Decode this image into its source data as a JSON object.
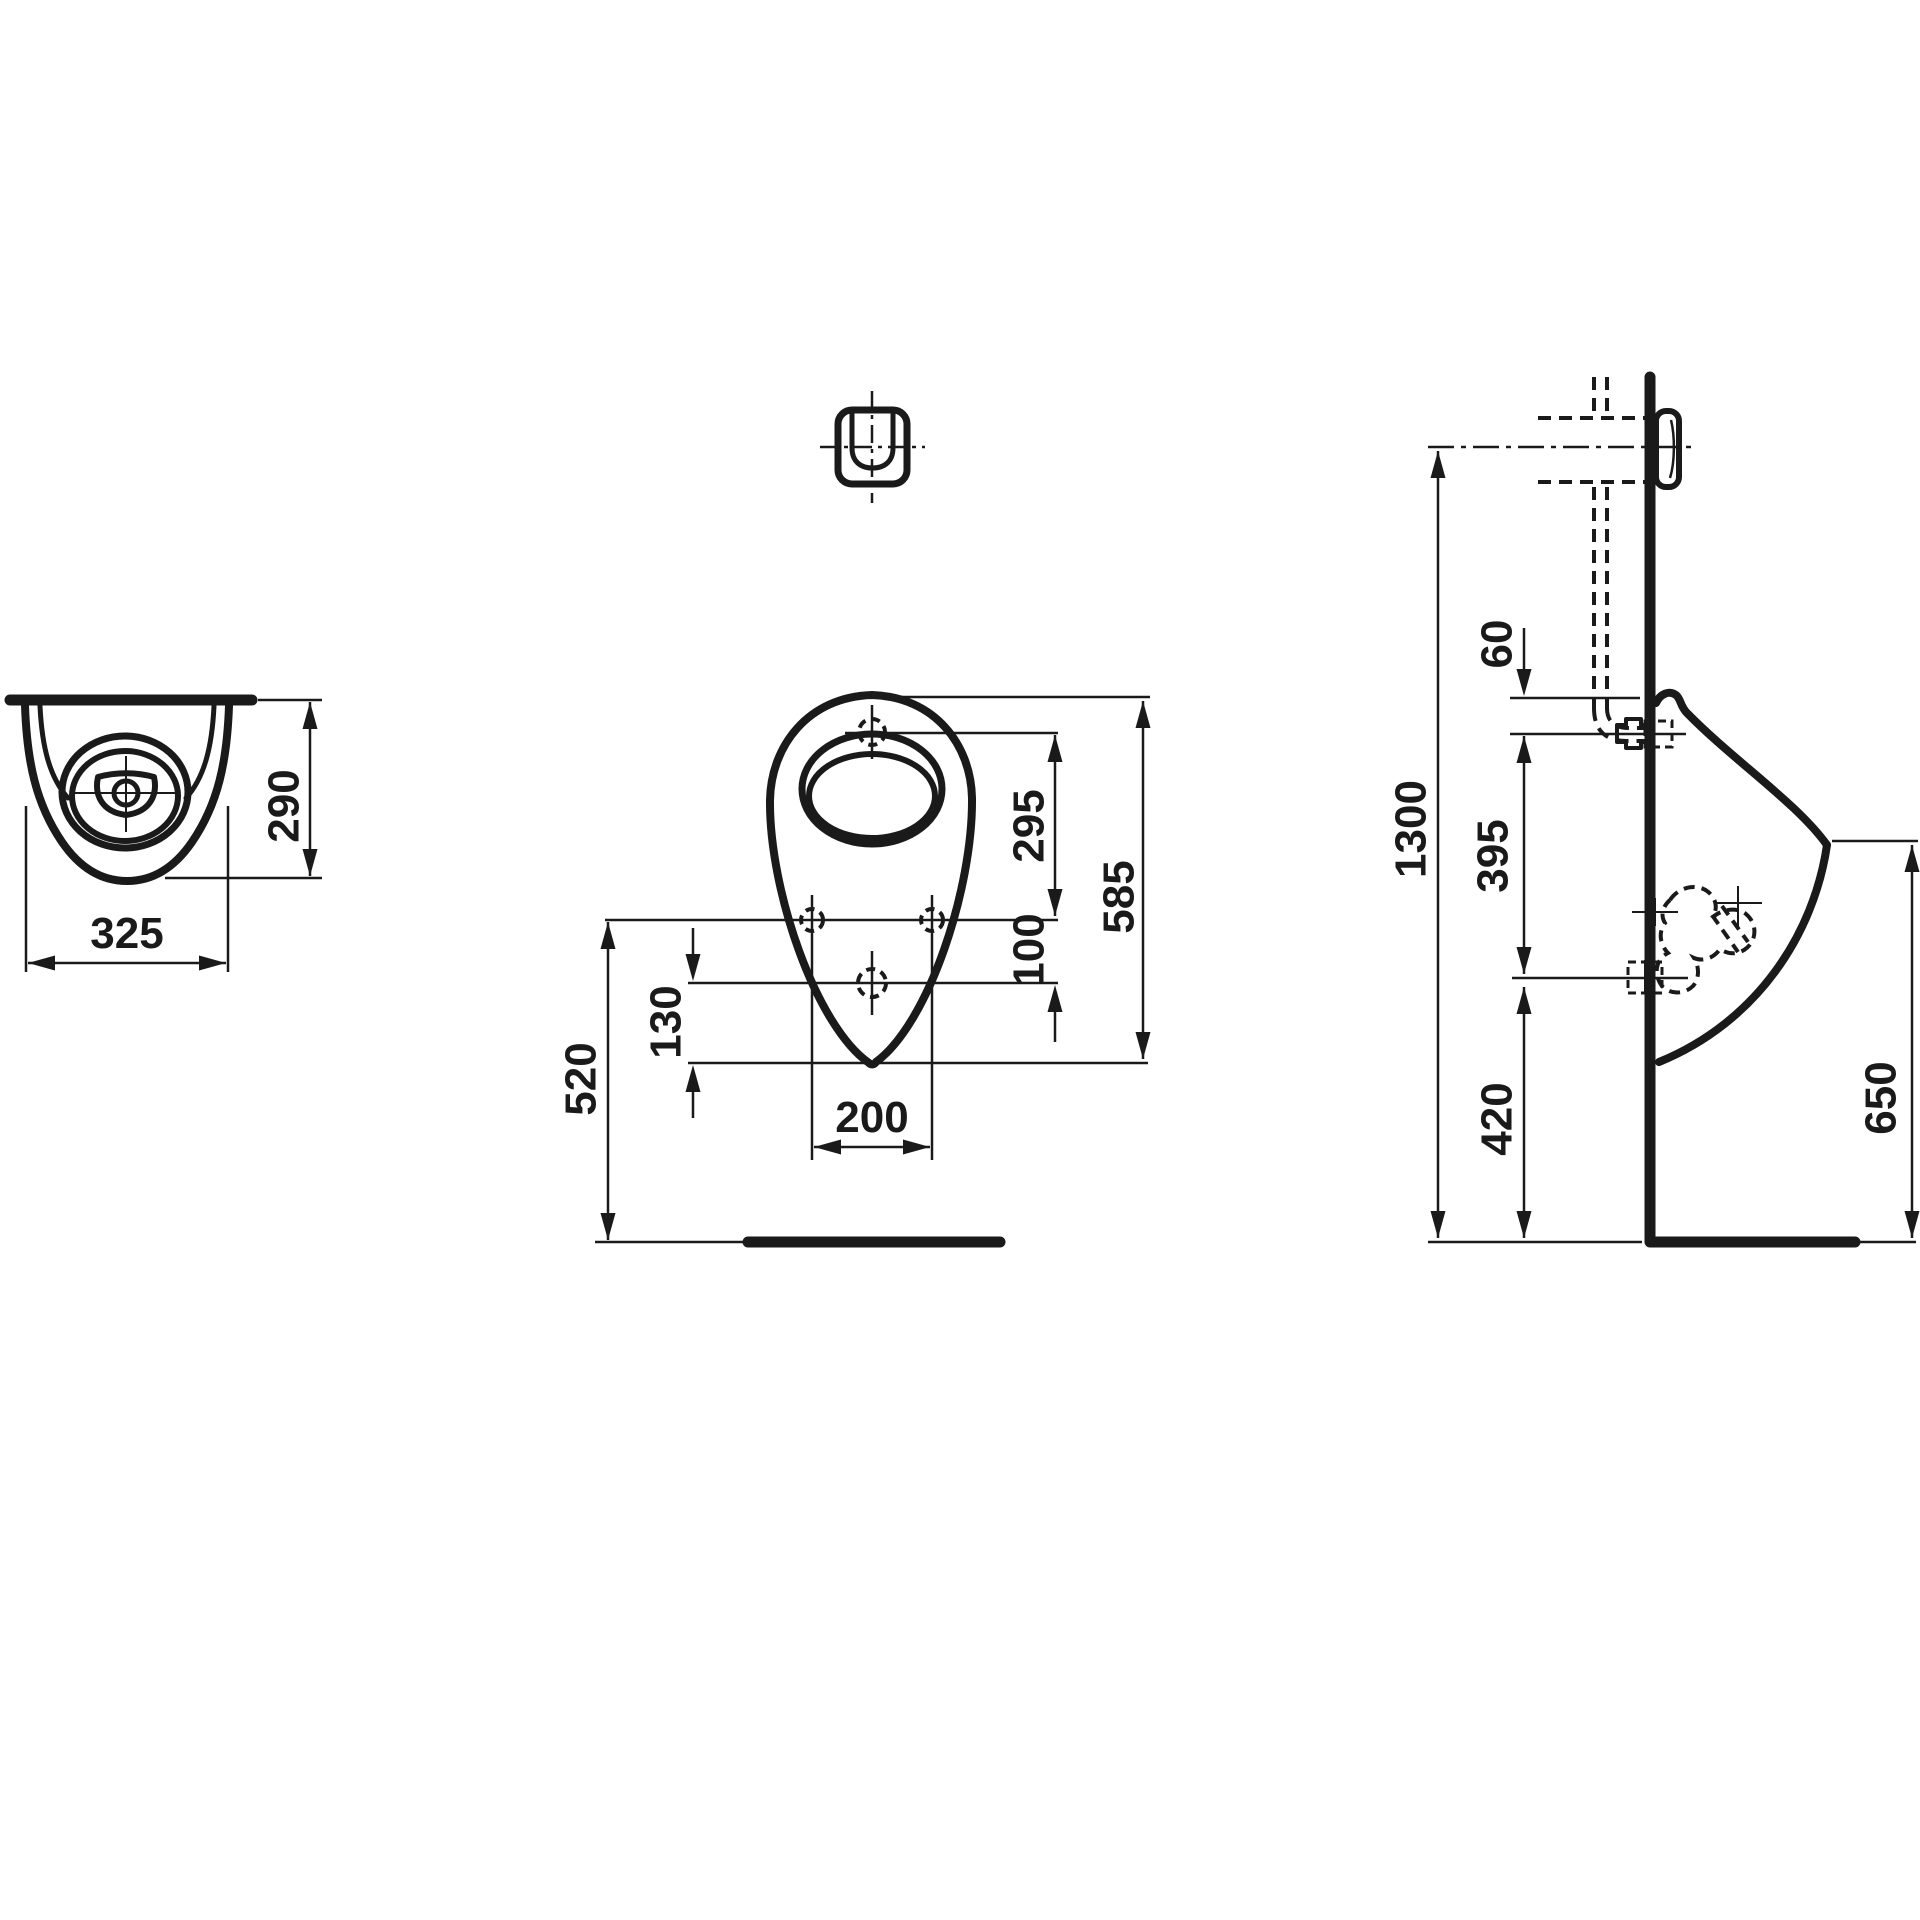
{
  "drawing": {
    "line_color": "#1a1a1a",
    "background": "#ffffff",
    "dimensions": {
      "top_view": {
        "depth": "290",
        "width": "325"
      },
      "front_view": {
        "rim_to_holes": "295",
        "overall_height": "585",
        "holes_to_outlet": "100",
        "outlet_to_bottom": "130",
        "hole_spacing": "200",
        "holes_above_floor": "520"
      },
      "side_view": {
        "top_to_inlet": "60",
        "inlet_to_outlet": "395",
        "supply_centerline_above_floor": "1300",
        "outlet_above_floor": "420",
        "front_edge_above_floor": "650"
      }
    }
  }
}
